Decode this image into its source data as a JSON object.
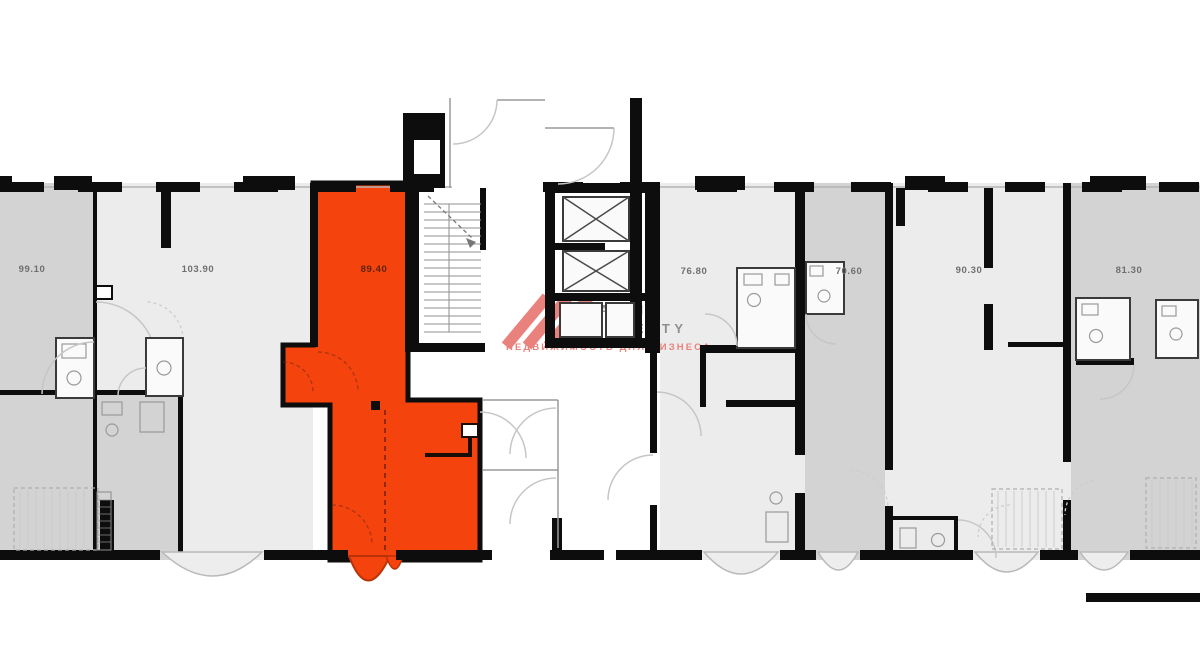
{
  "page": {
    "background": "#ffffff"
  },
  "floorplan": {
    "units": [
      {
        "name": "unit-1",
        "area": "99.10",
        "shade": "dark"
      },
      {
        "name": "unit-2",
        "area": "103.90",
        "shade": "light"
      },
      {
        "name": "unit-highlighted",
        "area": "89.40",
        "shade": "highlight",
        "highlighted": true
      },
      {
        "name": "unit-4",
        "area": "76.80",
        "shade": "light"
      },
      {
        "name": "unit-5",
        "area": "70.60",
        "shade": "dark"
      },
      {
        "name": "unit-6",
        "area": "90.30",
        "shade": "light"
      },
      {
        "name": "unit-7",
        "area": "81.30",
        "shade": "dark"
      }
    ],
    "colors": {
      "highlight": "#f4430d",
      "highlight_dark": "#b93207",
      "unit_dark": "#d3d3d3",
      "unit_light": "#ececec",
      "wall": "#0d0d0d",
      "label": "#6f6f6f",
      "label_on_highlight": "#5f230c"
    },
    "icons": {
      "elevator_icon": "crossed-box",
      "stairs_icon": "tread-lines",
      "door_icon": "quarter-arc"
    }
  },
  "watermark": {
    "brand_top": "MALINA",
    "brand_bottom": "PROPERTY",
    "tagline": "НЕДВИЖИМОСТЬ ДЛЯ БИЗНЕСА",
    "brand_color": "#8f8f8f",
    "accent_color": "#e9827d"
  }
}
